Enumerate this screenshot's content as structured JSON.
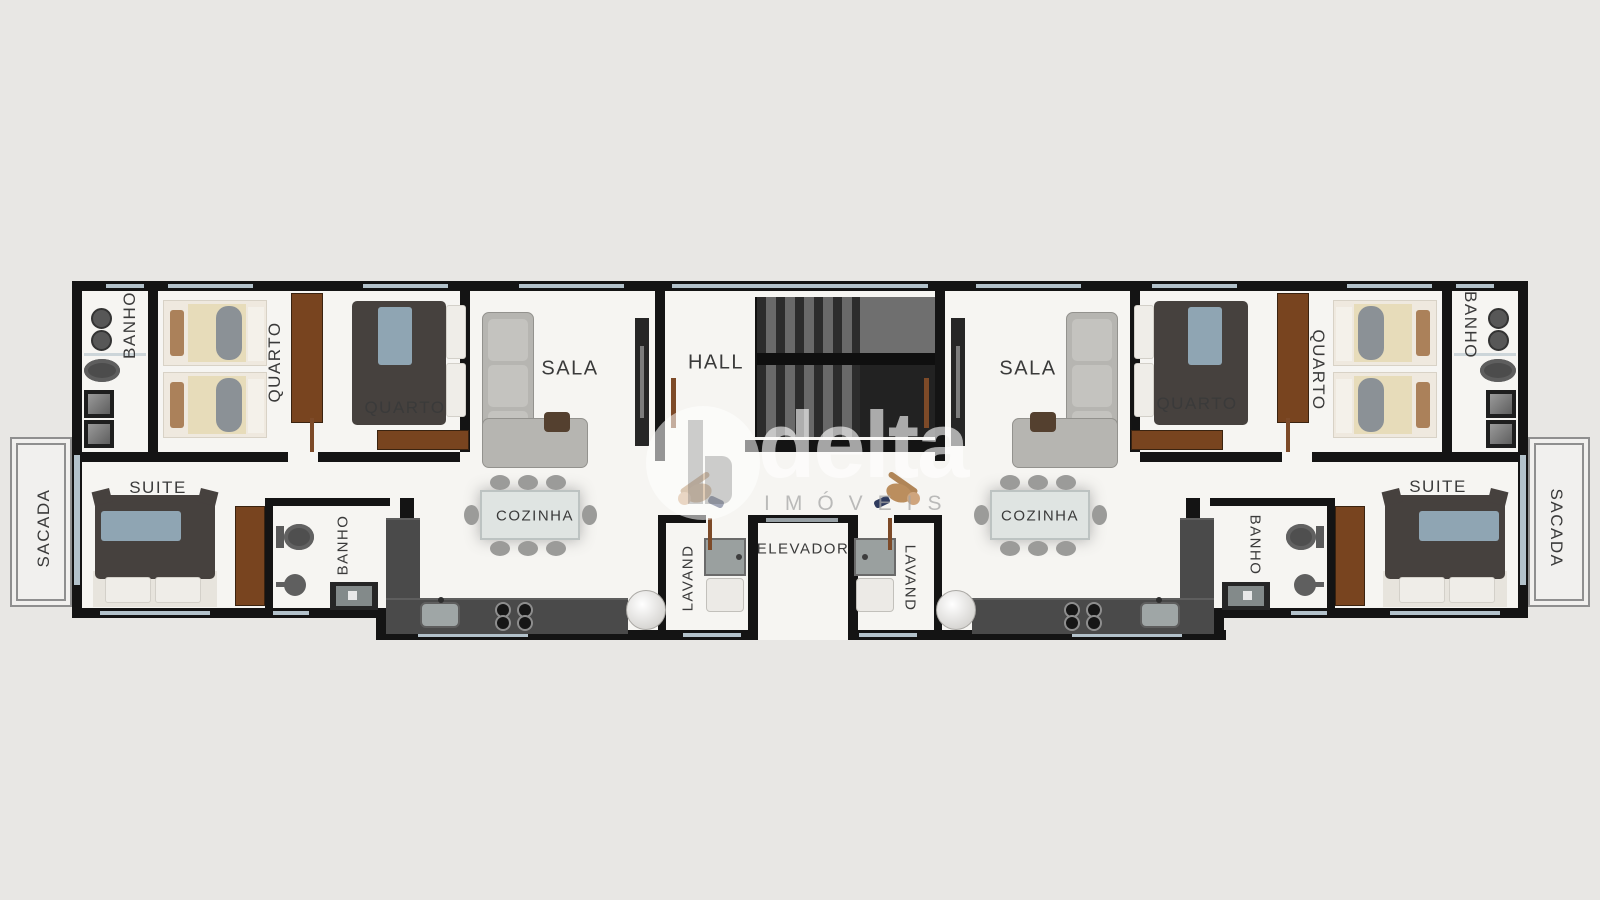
{
  "title": "Planta baixa - pavimento tipo",
  "watermark": {
    "brand": "delta",
    "tagline": "IMÓVEIS",
    "icon": "building-circle-logo"
  },
  "rooms": {
    "sacada_left": "SACADA",
    "banho_top_left": "BANHO",
    "quarto_twin_left": "QUARTO",
    "quarto_double_left": "QUARTO",
    "sala_left": "SALA",
    "hall": "HALL",
    "sala_right": "SALA",
    "quarto_double_right": "QUARTO",
    "quarto_twin_right": "QUARTO",
    "banho_top_right": "BANHO",
    "sacada_right": "SACADA",
    "suite_left": "SUITE",
    "banho_suite_left": "BANHO",
    "cozinha_left": "COZINHA",
    "lavand_left": "LAVAND",
    "elevador": "ELEVADOR",
    "lavand_right": "LAVAND",
    "cozinha_right": "COZINHA",
    "banho_suite_right": "BANHO",
    "suite_right": "SUITE"
  },
  "colors": {
    "background": "#e8e7e4",
    "floor": "#f6f5f2",
    "wall": "#141414",
    "window": "#b3c2cb",
    "wardrobe": "#78441f",
    "bed_duvet": "#46413e",
    "bed_runner_blue": "#8fa5b3",
    "bed_cream": "#e7dcba",
    "sofa": "#b6b5b1",
    "counter": "#4a4a4a",
    "stairs_dark": "#2c2c2c",
    "stairs_light": "#696969",
    "balcony_rail": "#8f8f8f",
    "label_text": "#3a3a3a"
  }
}
